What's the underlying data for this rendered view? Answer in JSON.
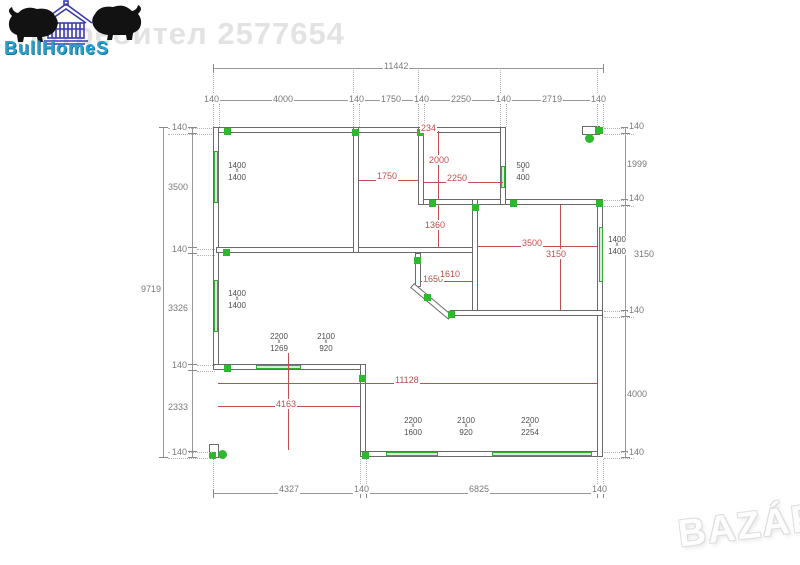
{
  "watermarks": {
    "user_text": "Потребител 2577654",
    "bazar_text": "BAZÁR"
  },
  "logo": {
    "brand": "BullHomeS"
  },
  "colors": {
    "red": "#c0504d",
    "green": "#2db82d",
    "dim_gray": "#7a7a7a",
    "label_gray": "#4f4f4f"
  },
  "plan": {
    "overall_dims": {
      "top": "11442",
      "left": "9719"
    },
    "top_chain": [
      "140",
      "4000",
      "140",
      "1750",
      "140",
      "2250",
      "140",
      "2719",
      "140"
    ],
    "left_chain": [
      "140",
      "3500",
      "140",
      "3326",
      "140",
      "2333",
      "140"
    ],
    "right_chain": [
      "140",
      "1999",
      "140",
      "3150",
      "140",
      "4000",
      "140"
    ],
    "bottom_chain": [
      "4327",
      "140",
      "6825",
      "140"
    ],
    "labels_gray": [
      {
        "t": "11442",
        "x": 383,
        "y": 61
      },
      {
        "t": "140",
        "x": 203,
        "y": 94
      },
      {
        "t": "4000",
        "x": 272,
        "y": 94
      },
      {
        "t": "140",
        "x": 348,
        "y": 94
      },
      {
        "t": "1750",
        "x": 380,
        "y": 94
      },
      {
        "t": "140",
        "x": 413,
        "y": 94
      },
      {
        "t": "2250",
        "x": 450,
        "y": 94
      },
      {
        "t": "140",
        "x": 495,
        "y": 94
      },
      {
        "t": "2719",
        "x": 541,
        "y": 94
      },
      {
        "t": "140",
        "x": 590,
        "y": 94
      },
      {
        "t": "9719",
        "x": 140,
        "y": 284
      },
      {
        "t": "140",
        "x": 171,
        "y": 122
      },
      {
        "t": "3500",
        "x": 167,
        "y": 182
      },
      {
        "t": "140",
        "x": 171,
        "y": 244
      },
      {
        "t": "3326",
        "x": 167,
        "y": 303
      },
      {
        "t": "140",
        "x": 171,
        "y": 360
      },
      {
        "t": "2333",
        "x": 167,
        "y": 402
      },
      {
        "t": "140",
        "x": 171,
        "y": 447
      },
      {
        "t": "140",
        "x": 628,
        "y": 121
      },
      {
        "t": "1999",
        "x": 626,
        "y": 159
      },
      {
        "t": "140",
        "x": 628,
        "y": 193
      },
      {
        "t": "3150",
        "x": 633,
        "y": 249
      },
      {
        "t": "140",
        "x": 628,
        "y": 305
      },
      {
        "t": "4000",
        "x": 626,
        "y": 389
      },
      {
        "t": "140",
        "x": 628,
        "y": 447
      },
      {
        "t": "4327",
        "x": 278,
        "y": 484
      },
      {
        "t": "140",
        "x": 353,
        "y": 484
      },
      {
        "t": "6825",
        "x": 468,
        "y": 484
      },
      {
        "t": "140",
        "x": 591,
        "y": 484
      }
    ],
    "labels_red": [
      {
        "t": "234",
        "x": 420,
        "y": 123
      },
      {
        "t": "2000",
        "x": 428,
        "y": 155
      },
      {
        "t": "1750",
        "x": 376,
        "y": 171
      },
      {
        "t": "2250",
        "x": 446,
        "y": 173
      },
      {
        "t": "1360",
        "x": 424,
        "y": 220
      },
      {
        "t": "1650",
        "x": 422,
        "y": 274
      },
      {
        "t": "1610",
        "x": 439,
        "y": 269
      },
      {
        "t": "3500",
        "x": 521,
        "y": 238
      },
      {
        "t": "3150",
        "x": 545,
        "y": 249
      },
      {
        "t": "1290",
        "x": 270,
        "y": 343
      },
      {
        "t": "11128",
        "x": 394,
        "y": 375
      },
      {
        "t": "4163",
        "x": 275,
        "y": 399
      }
    ],
    "opening_labels": [
      {
        "lines": [
          "1400",
          "x",
          "1400"
        ],
        "x": 224,
        "y": 162
      },
      {
        "lines": [
          "1400",
          "x",
          "1400"
        ],
        "x": 224,
        "y": 290
      },
      {
        "lines": [
          "500",
          "x",
          "400"
        ],
        "x": 510,
        "y": 162
      },
      {
        "lines": [
          "2200",
          "x",
          "1269"
        ],
        "x": 266,
        "y": 333
      },
      {
        "lines": [
          "2100",
          "x",
          "920"
        ],
        "x": 313,
        "y": 333
      },
      {
        "lines": [
          "2200",
          "x",
          "1600"
        ],
        "x": 400,
        "y": 417
      },
      {
        "lines": [
          "2100",
          "x",
          "920"
        ],
        "x": 453,
        "y": 417
      },
      {
        "lines": [
          "2200",
          "x",
          "2254"
        ],
        "x": 517,
        "y": 417
      },
      {
        "lines": [
          "1400",
          "x",
          "1400"
        ],
        "x": 604,
        "y": 236
      }
    ]
  }
}
